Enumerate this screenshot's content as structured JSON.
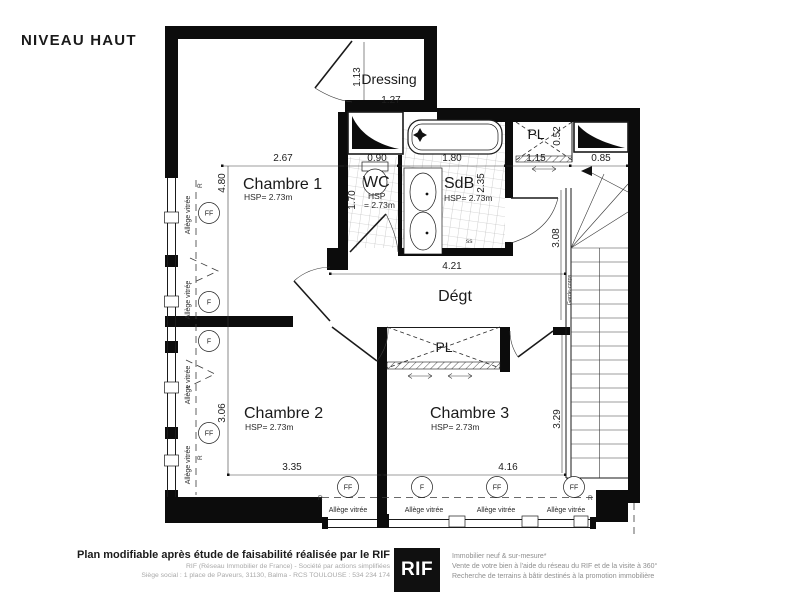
{
  "title": "NIVEAU HAUT",
  "plan": {
    "dressing": {
      "name": "Dressing",
      "w": "1.27",
      "h": "1.13"
    },
    "chambre1": {
      "name": "Chambre 1",
      "hsp": "HSP= 2.73m",
      "w": "2.67",
      "h": "4.80"
    },
    "wc": {
      "name": "WC",
      "hsp1": "HSP",
      "hsp2": "= 2.73m",
      "w": "0.90",
      "h": "1.70"
    },
    "sdb": {
      "name": "SdB",
      "hsp": "HSP= 2.73m",
      "w": "1.80",
      "h": "2.35",
      "ss": "ss"
    },
    "pl_top": {
      "name": "PL",
      "d": "0.52"
    },
    "palier": {
      "w": "1.15"
    },
    "stairs": {
      "top_w": "0.85",
      "h": "3.08",
      "guard": "Garde-corps"
    },
    "degt": {
      "name": "Dégt",
      "w": "4.21"
    },
    "pl_mid": {
      "name": "PL"
    },
    "chambre2": {
      "name": "Chambre 2",
      "hsp": "HSP= 2.73m",
      "w": "3.35",
      "h": "3.06"
    },
    "chambre3": {
      "name": "Chambre 3",
      "hsp": "HSP= 2.73m",
      "w": "4.16",
      "h": "3.29"
    },
    "windows": {
      "allege": "Allège vitrée",
      "ff": "FF",
      "f": "F",
      "r": "R"
    }
  },
  "footer": {
    "left_bold": "Plan modifiable après étude de faisabilité réalisée par le RIF",
    "left_line2": "RIF (Réseau Immobilier de France) - Société par actions simplifiées",
    "left_line3": "Siège social : 1 place de Paveurs, 31130, Balma - RCS TOULOUSE : 534 234 174",
    "logo": "RIF",
    "right_line1": "Immobilier neuf & sur-mesure*",
    "right_line2": "Vente de votre bien à l'aide du réseau du RIF et de la visite à 360°",
    "right_line3": "Recherche de terrains à bâtir destinés à la promotion immobilière"
  }
}
